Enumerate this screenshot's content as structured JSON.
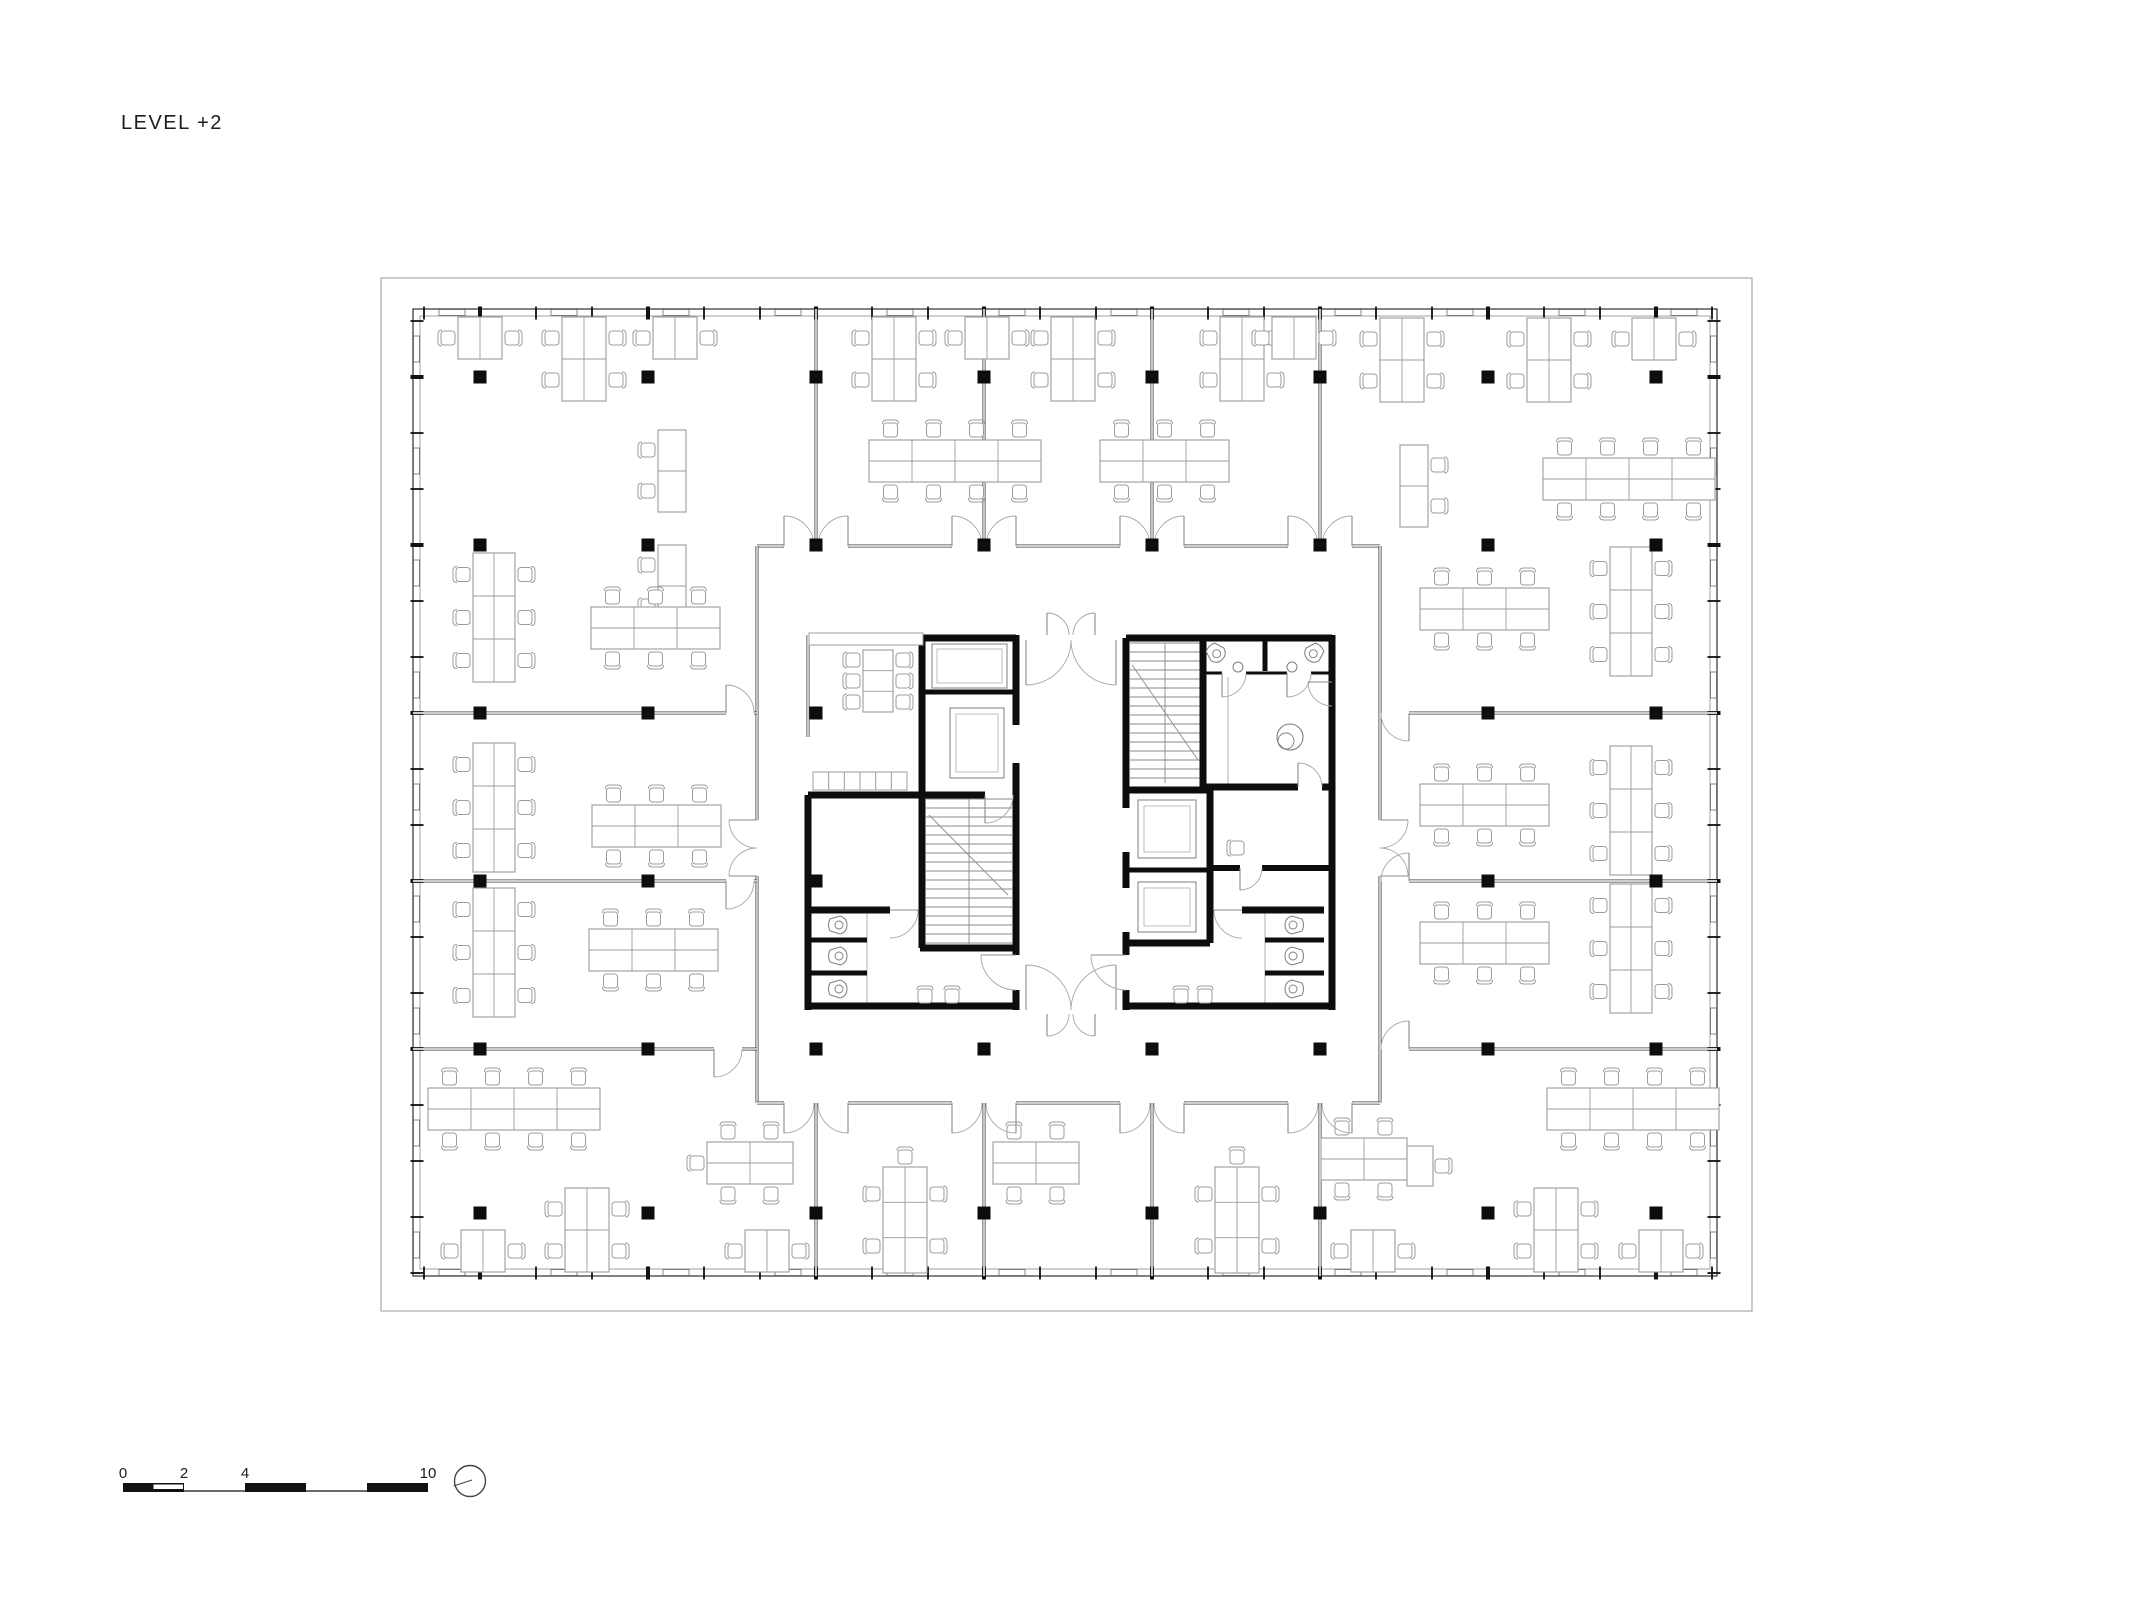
{
  "title": "LEVEL +2",
  "scale_bar": {
    "marks": [
      {
        "label": "0",
        "m": 0
      },
      {
        "label": "2",
        "m": 2
      },
      {
        "label": "4",
        "m": 4
      },
      {
        "label": "10",
        "m": 10
      }
    ],
    "x": 123,
    "y": 1483,
    "h": 9,
    "px_per_m": 30.5,
    "filled": [
      [
        0,
        2
      ],
      [
        4,
        6
      ],
      [
        8,
        10
      ]
    ],
    "lines": [
      [
        2,
        4
      ],
      [
        6,
        8
      ]
    ],
    "notch": [
      1,
      2
    ]
  },
  "north_arrow": {
    "cx": 470,
    "cy": 1481,
    "r": 15.5
  },
  "colors": {
    "ink": "#0d0d0d",
    "wall_dark": "#3c3c3c",
    "wall_mid": "#6e6e6e",
    "furniture": "#9c9c9c",
    "light": "#bdbdbd",
    "door": "#a8a8a8",
    "stair": "#8a8a8a",
    "fixture": "#7d7d7d",
    "white": "#ffffff"
  },
  "plan": {
    "outer_border": [
      381,
      278,
      1752,
      1311
    ],
    "facade": {
      "x1": 413,
      "y1": 309,
      "x2": 1717,
      "y2": 1276,
      "band": 7,
      "module": 56
    },
    "grid": {
      "cols": [
        480,
        648,
        816,
        984,
        1152,
        1320,
        1488,
        1656
      ],
      "rows": [
        377,
        545,
        713,
        881,
        1049,
        1213
      ],
      "size": 13,
      "skip": [
        [
          984,
          713
        ],
        [
          984,
          881
        ],
        [
          1152,
          713
        ],
        [
          1152,
          881
        ],
        [
          1320,
          713
        ],
        [
          1320,
          881
        ]
      ]
    },
    "plaza": [
      757,
      546,
      1380,
      1103
    ],
    "thin_walls": [
      [
        757,
        546,
        784,
        546
      ],
      [
        848,
        546,
        952,
        546
      ],
      [
        1016,
        546,
        1120,
        546
      ],
      [
        1184,
        546,
        1288,
        546
      ],
      [
        1352,
        546,
        1380,
        546
      ],
      [
        757,
        546,
        757,
        820
      ],
      [
        757,
        876,
        757,
        1103
      ],
      [
        1380,
        546,
        1380,
        820
      ],
      [
        1380,
        876,
        1380,
        1103
      ],
      [
        757,
        1103,
        784,
        1103
      ],
      [
        848,
        1103,
        952,
        1103
      ],
      [
        1016,
        1103,
        1120,
        1103
      ],
      [
        1184,
        1103,
        1288,
        1103
      ],
      [
        1352,
        1103,
        1380,
        1103
      ],
      [
        816,
        309,
        816,
        546
      ],
      [
        984,
        309,
        984,
        546
      ],
      [
        1152,
        309,
        1152,
        546
      ],
      [
        1320,
        309,
        1320,
        546
      ],
      [
        816,
        1103,
        816,
        1276
      ],
      [
        984,
        1103,
        984,
        1276
      ],
      [
        1152,
        1103,
        1152,
        1276
      ],
      [
        1320,
        1103,
        1320,
        1276
      ],
      [
        413,
        713,
        726,
        713
      ],
      [
        754,
        713,
        757,
        713
      ],
      [
        413,
        881,
        726,
        881
      ],
      [
        754,
        881,
        757,
        881
      ],
      [
        413,
        1049,
        714,
        1049
      ],
      [
        742,
        1049,
        757,
        1049
      ],
      [
        1409,
        713,
        1717,
        713
      ],
      [
        1409,
        881,
        1717,
        881
      ],
      [
        1409,
        1049,
        1717,
        1049
      ],
      [
        808,
        635,
        808,
        737
      ]
    ],
    "thick_walls": [
      [
        922,
        638,
        1016,
        638,
        7
      ],
      [
        922,
        635,
        922,
        795,
        7
      ],
      [
        922,
        692,
        1016,
        692,
        5
      ],
      [
        1016,
        635,
        1016,
        725,
        7
      ],
      [
        1016,
        763,
        1016,
        955,
        7
      ],
      [
        1016,
        990,
        1016,
        1010,
        7
      ],
      [
        808,
        795,
        985,
        795,
        7
      ],
      [
        1013,
        795,
        1016,
        795,
        7
      ],
      [
        808,
        795,
        808,
        1010,
        7
      ],
      [
        922,
        795,
        922,
        948,
        7
      ],
      [
        920,
        948,
        1016,
        948,
        7
      ],
      [
        808,
        910,
        890,
        910,
        7
      ],
      [
        808,
        940,
        867,
        940,
        5
      ],
      [
        808,
        973,
        867,
        973,
        5
      ],
      [
        808,
        1006,
        1016,
        1006,
        7
      ],
      [
        1126,
        638,
        1332,
        638,
        7
      ],
      [
        1126,
        638,
        1126,
        808,
        7
      ],
      [
        1126,
        852,
        1126,
        888,
        7
      ],
      [
        1126,
        932,
        1126,
        955,
        7
      ],
      [
        1126,
        990,
        1126,
        1010,
        7
      ],
      [
        1203,
        638,
        1203,
        787,
        7
      ],
      [
        1265,
        638,
        1265,
        671,
        5
      ],
      [
        1332,
        635,
        1332,
        1010,
        7
      ],
      [
        1203,
        787,
        1298,
        787,
        7
      ],
      [
        1322,
        787,
        1332,
        787,
        7
      ],
      [
        1126,
        790,
        1210,
        790,
        7
      ],
      [
        1210,
        790,
        1210,
        943,
        7
      ],
      [
        1126,
        870,
        1210,
        870,
        5
      ],
      [
        1126,
        943,
        1210,
        943,
        7
      ],
      [
        1210,
        868,
        1240,
        868,
        6
      ],
      [
        1262,
        868,
        1332,
        868,
        6
      ],
      [
        1242,
        910,
        1324,
        910,
        7
      ],
      [
        1265,
        940,
        1324,
        940,
        5
      ],
      [
        1265,
        973,
        1324,
        973,
        5
      ],
      [
        1126,
        1006,
        1332,
        1006,
        7
      ]
    ],
    "light_walls": [
      [
        867,
        910,
        867,
        1006
      ],
      [
        1265,
        910,
        1265,
        1006
      ],
      [
        1203,
        673,
        1203,
        785
      ],
      [
        1228,
        677,
        1228,
        785
      ]
    ],
    "wc_thin": [
      [
        1203,
        673,
        1222,
        673
      ],
      [
        1246,
        673,
        1287,
        673
      ],
      [
        1311,
        673,
        1332,
        673
      ]
    ],
    "doors": [
      [
        784,
        546,
        814,
        546,
        0
      ],
      [
        848,
        546,
        818,
        546,
        1
      ],
      [
        952,
        546,
        982,
        546,
        0
      ],
      [
        1016,
        546,
        986,
        546,
        1
      ],
      [
        1120,
        546,
        1150,
        546,
        0
      ],
      [
        1184,
        546,
        1154,
        546,
        1
      ],
      [
        1288,
        546,
        1318,
        546,
        0
      ],
      [
        1352,
        546,
        1322,
        546,
        1
      ],
      [
        784,
        1103,
        814,
        1103,
        1
      ],
      [
        848,
        1103,
        818,
        1103,
        0
      ],
      [
        952,
        1103,
        982,
        1103,
        1
      ],
      [
        1016,
        1103,
        986,
        1103,
        0
      ],
      [
        1120,
        1103,
        1150,
        1103,
        1
      ],
      [
        1184,
        1103,
        1154,
        1103,
        0
      ],
      [
        1288,
        1103,
        1318,
        1103,
        1
      ],
      [
        1352,
        1103,
        1322,
        1103,
        0
      ],
      [
        757,
        820,
        757,
        848,
        1
      ],
      [
        757,
        876,
        757,
        848,
        0
      ],
      [
        1380,
        820,
        1380,
        848,
        0
      ],
      [
        1380,
        876,
        1380,
        848,
        1
      ],
      [
        726,
        713,
        754,
        713,
        0
      ],
      [
        726,
        881,
        754,
        881,
        1
      ],
      [
        714,
        1049,
        742,
        1049,
        1
      ],
      [
        1409,
        713,
        1381,
        713,
        0
      ],
      [
        1409,
        881,
        1381,
        881,
        1
      ],
      [
        1409,
        1049,
        1381,
        1049,
        1
      ],
      [
        1026,
        640,
        1071,
        640,
        1
      ],
      [
        1116,
        640,
        1071,
        640,
        0
      ],
      [
        1047,
        635,
        1069,
        635,
        0
      ],
      [
        1095,
        635,
        1073,
        635,
        1
      ],
      [
        1026,
        1010,
        1071,
        1010,
        0
      ],
      [
        1116,
        1010,
        1071,
        1010,
        1
      ],
      [
        1047,
        1014,
        1069,
        1014,
        1
      ],
      [
        1095,
        1014,
        1073,
        1014,
        0
      ],
      [
        985,
        795,
        1013,
        795,
        1
      ],
      [
        1016,
        955,
        1016,
        990,
        1
      ],
      [
        1126,
        955,
        1126,
        990,
        1
      ],
      [
        890,
        910,
        890,
        938,
        0
      ],
      [
        1242,
        910,
        1242,
        938,
        1
      ],
      [
        1222,
        673,
        1246,
        673,
        1
      ],
      [
        1287,
        673,
        1311,
        673,
        1
      ],
      [
        1332,
        682,
        1332,
        706,
        1
      ],
      [
        1298,
        787,
        1322,
        787,
        0
      ],
      [
        1240,
        868,
        1262,
        868,
        1
      ]
    ],
    "stairs": [
      {
        "x": 926,
        "y": 799,
        "w": 86,
        "h": 145,
        "step": 9,
        "divider": 969,
        "diag": [
          929,
          815,
          1008,
          895
        ]
      },
      {
        "x": 1130,
        "y": 643,
        "w": 70,
        "h": 140,
        "step": 9,
        "divider": 1165,
        "diag": [
          1132,
          665,
          1198,
          760
        ]
      }
    ],
    "lifts": [
      {
        "car": [
          932,
          644,
          75,
          44
        ],
        "inset": 5
      },
      {
        "car": [
          950,
          708,
          54,
          70
        ],
        "inset": 6
      },
      {
        "car": [
          1138,
          800,
          58,
          58
        ],
        "inset": 6
      },
      {
        "car": [
          1138,
          882,
          58,
          50
        ],
        "inset": 6
      }
    ],
    "wc_fixtures": [
      [
        838,
        925,
        0
      ],
      [
        838,
        956,
        0
      ],
      [
        838,
        989,
        0
      ],
      [
        1294,
        925,
        180
      ],
      [
        1294,
        956,
        180
      ],
      [
        1294,
        989,
        180
      ],
      [
        1216,
        653,
        45
      ],
      [
        1314,
        653,
        135
      ]
    ],
    "sinks": [
      [
        1238,
        667
      ],
      [
        1292,
        667
      ]
    ],
    "shower": [
      1290,
      737
    ],
    "misc_rects": [
      {
        "r": [
          809,
          633,
          114,
          12
        ],
        "cells": 1
      },
      {
        "r": [
          813,
          772,
          94,
          18
        ],
        "cells": 6
      }
    ],
    "furniture": [
      [
        "d1",
        458,
        317
      ],
      [
        "d2v",
        562,
        317
      ],
      [
        "d1",
        653,
        317
      ],
      [
        "d2v",
        872,
        317
      ],
      [
        "d1",
        965,
        317
      ],
      [
        "d2v",
        1051,
        317
      ],
      [
        "d2v",
        1220,
        317
      ],
      [
        "d1",
        1272,
        317
      ],
      [
        "d2v",
        1380,
        318
      ],
      [
        "d2v",
        1527,
        318
      ],
      [
        "d1",
        1632,
        318
      ],
      [
        "sdL",
        658,
        430
      ],
      [
        "sdL",
        658,
        545
      ],
      [
        "b6v",
        473,
        553
      ],
      [
        "b6h",
        591,
        607
      ],
      [
        "b6v",
        473,
        743
      ],
      [
        "b6h",
        592,
        805
      ],
      [
        "b6v",
        473,
        888
      ],
      [
        "b6h",
        589,
        929
      ],
      [
        "sdR",
        1400,
        445
      ],
      [
        "b6v",
        1610,
        547
      ],
      [
        "b6h",
        1420,
        588
      ],
      [
        "b6v",
        1610,
        746
      ],
      [
        "b6h",
        1420,
        784
      ],
      [
        "b6v",
        1610,
        884
      ],
      [
        "b6h",
        1420,
        922
      ],
      [
        "b8h",
        869,
        440
      ],
      [
        "b6h",
        1100,
        440
      ],
      [
        "b8h",
        1543,
        458
      ],
      [
        "b8h",
        428,
        1088
      ],
      [
        "b4hL",
        707,
        1142
      ],
      [
        "b4h",
        993,
        1142
      ],
      [
        "b4hR",
        1321,
        1138
      ],
      [
        "b8h",
        1547,
        1088
      ],
      [
        "d2v",
        565,
        1188
      ],
      [
        "d3v",
        883,
        1167
      ],
      [
        "d3v",
        1215,
        1167
      ],
      [
        "d2v",
        1534,
        1188
      ],
      [
        "d1",
        461,
        1230
      ],
      [
        "d1",
        745,
        1230
      ],
      [
        "d1",
        1351,
        1230
      ],
      [
        "d1",
        1639,
        1230
      ],
      [
        "mt6",
        863,
        650
      ],
      [
        "ch",
        925,
        997,
        90
      ],
      [
        "ch",
        952,
        997,
        90
      ],
      [
        "ch",
        1181,
        997,
        90
      ],
      [
        "ch",
        1205,
        997,
        90
      ],
      [
        "ch",
        1238,
        848,
        0
      ]
    ]
  }
}
